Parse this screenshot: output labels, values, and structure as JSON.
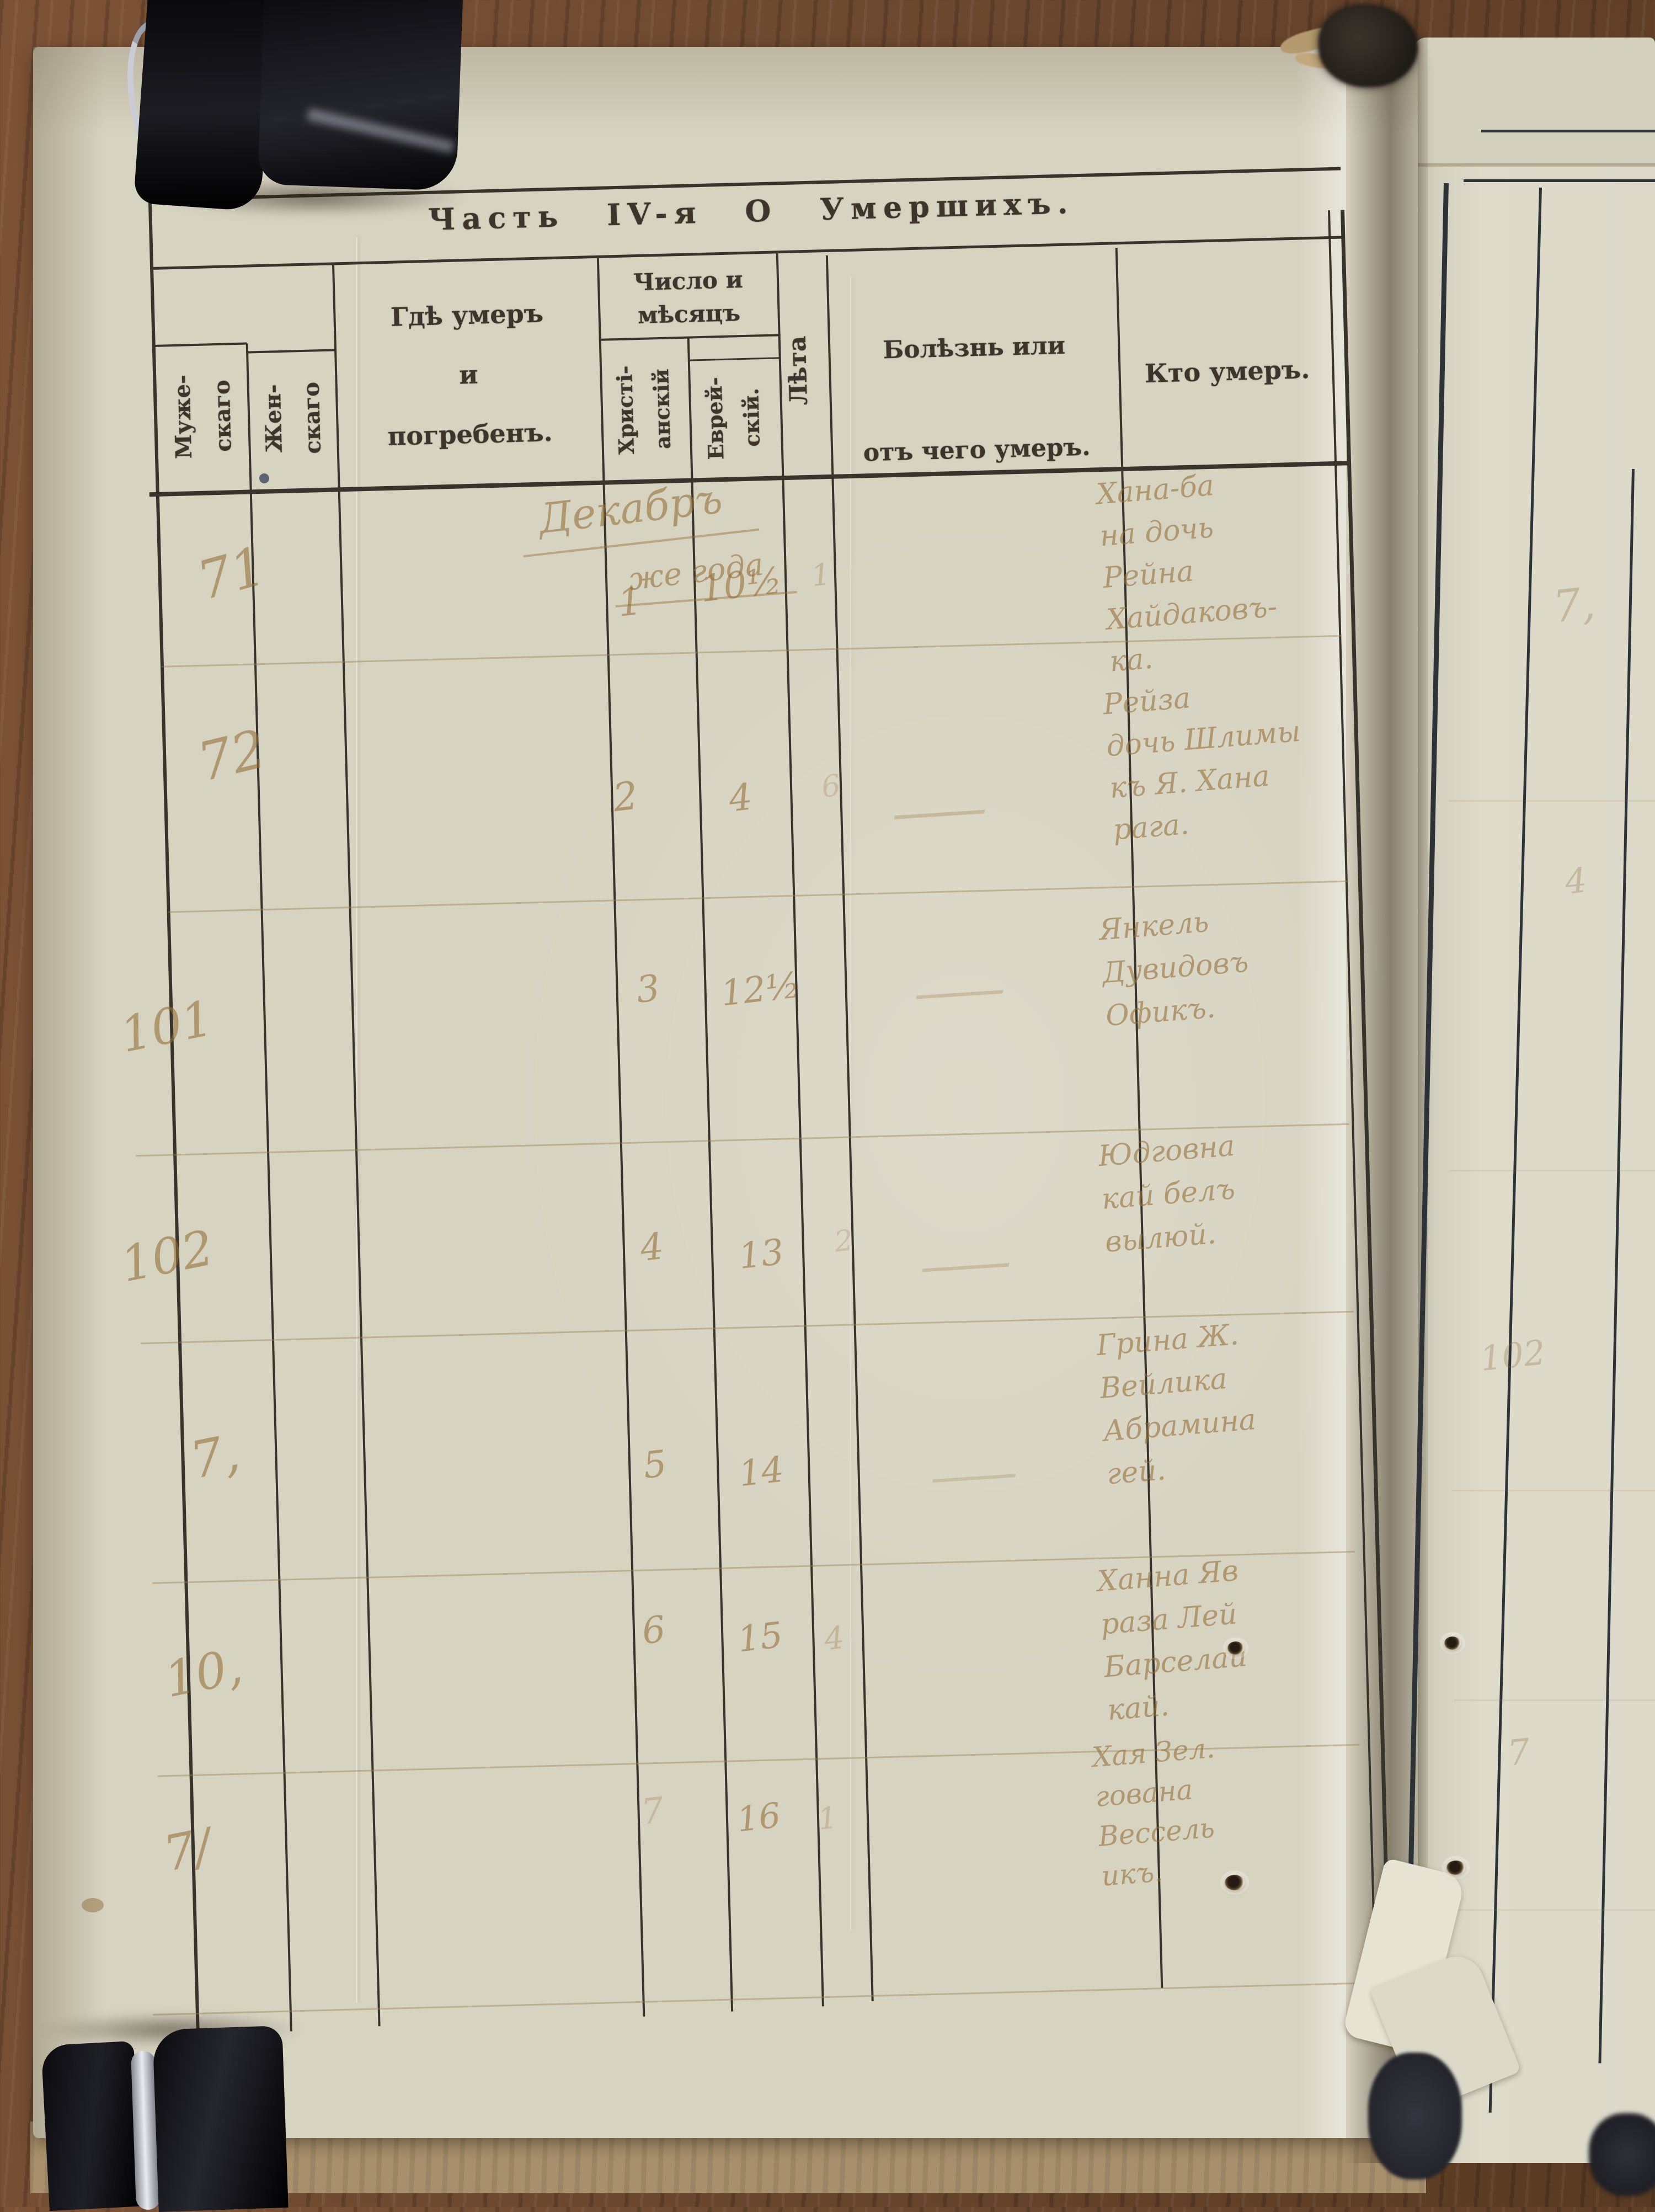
{
  "page": {
    "title": "Часть IV-я О Умершихъ.",
    "header": {
      "male": "Муже-\nскаго",
      "female": "Жен-\nскаго",
      "where": "Гдѣ умеръ\nи\nпогребенъ.",
      "date_group": "Число и\nмѣсяцъ",
      "christian": "Христі-\nанскій",
      "jewish": "Еврей-\nскій.",
      "age": "Лѣта",
      "cause": "Болѣзнь или\nотъ чего умеръ.",
      "who": "Кто умеръ."
    },
    "rows": [
      {
        "female_no": "71",
        "month_note": "Декабръ",
        "month_note2": "же года",
        "christian_day": "1",
        "jewish_day": "10½",
        "age": "1",
        "who": "Хана-ба\nна дочь\nРейна\nХайдаковъ-\nка."
      },
      {
        "female_no": "72",
        "christian_day": "2",
        "jewish_day": "4",
        "age": "6",
        "cause_mark": "—",
        "who": "Рейза\nдочь Шлимы\nкъ Я. Хана\nрага."
      },
      {
        "male_no": "101",
        "christian_day": "3",
        "jewish_day": "12½",
        "cause_mark": "—",
        "who": "Янкель\nДувидовъ\nОфикъ."
      },
      {
        "male_no": "102",
        "christian_day": "4",
        "jewish_day": "13",
        "age": "2",
        "cause_mark": "—",
        "who": "Юдговна\nкай белъ\nвылюй."
      },
      {
        "male_no": "7,",
        "christian_day": "5",
        "jewish_day": "14",
        "cause_mark": "—",
        "who": "Грина Ж.\nВейлика\nАбрамина\nгей."
      },
      {
        "male_no": "10,",
        "christian_day": "6",
        "jewish_day": "15",
        "age": "4",
        "who": "Ханна Яв\nраза Лей\nБарселай\nкай."
      },
      {
        "male_no": "7/",
        "christian_day": "7",
        "jewish_day": "16",
        "age": "1",
        "who": "Хая Зел.\nгована\nВессель\nикъ."
      }
    ]
  },
  "right_page": {
    "ghost_marks": [
      "7,",
      "4",
      "102",
      "7"
    ]
  },
  "colors": {
    "paper": "#d7d3c1",
    "paper_right": "#dcd9c9",
    "ink_print": "#3b352c",
    "ink_hand": "#9c7a45",
    "wood": "#6b4a33",
    "clip": "#121218",
    "cardboard": "#a8906d"
  }
}
